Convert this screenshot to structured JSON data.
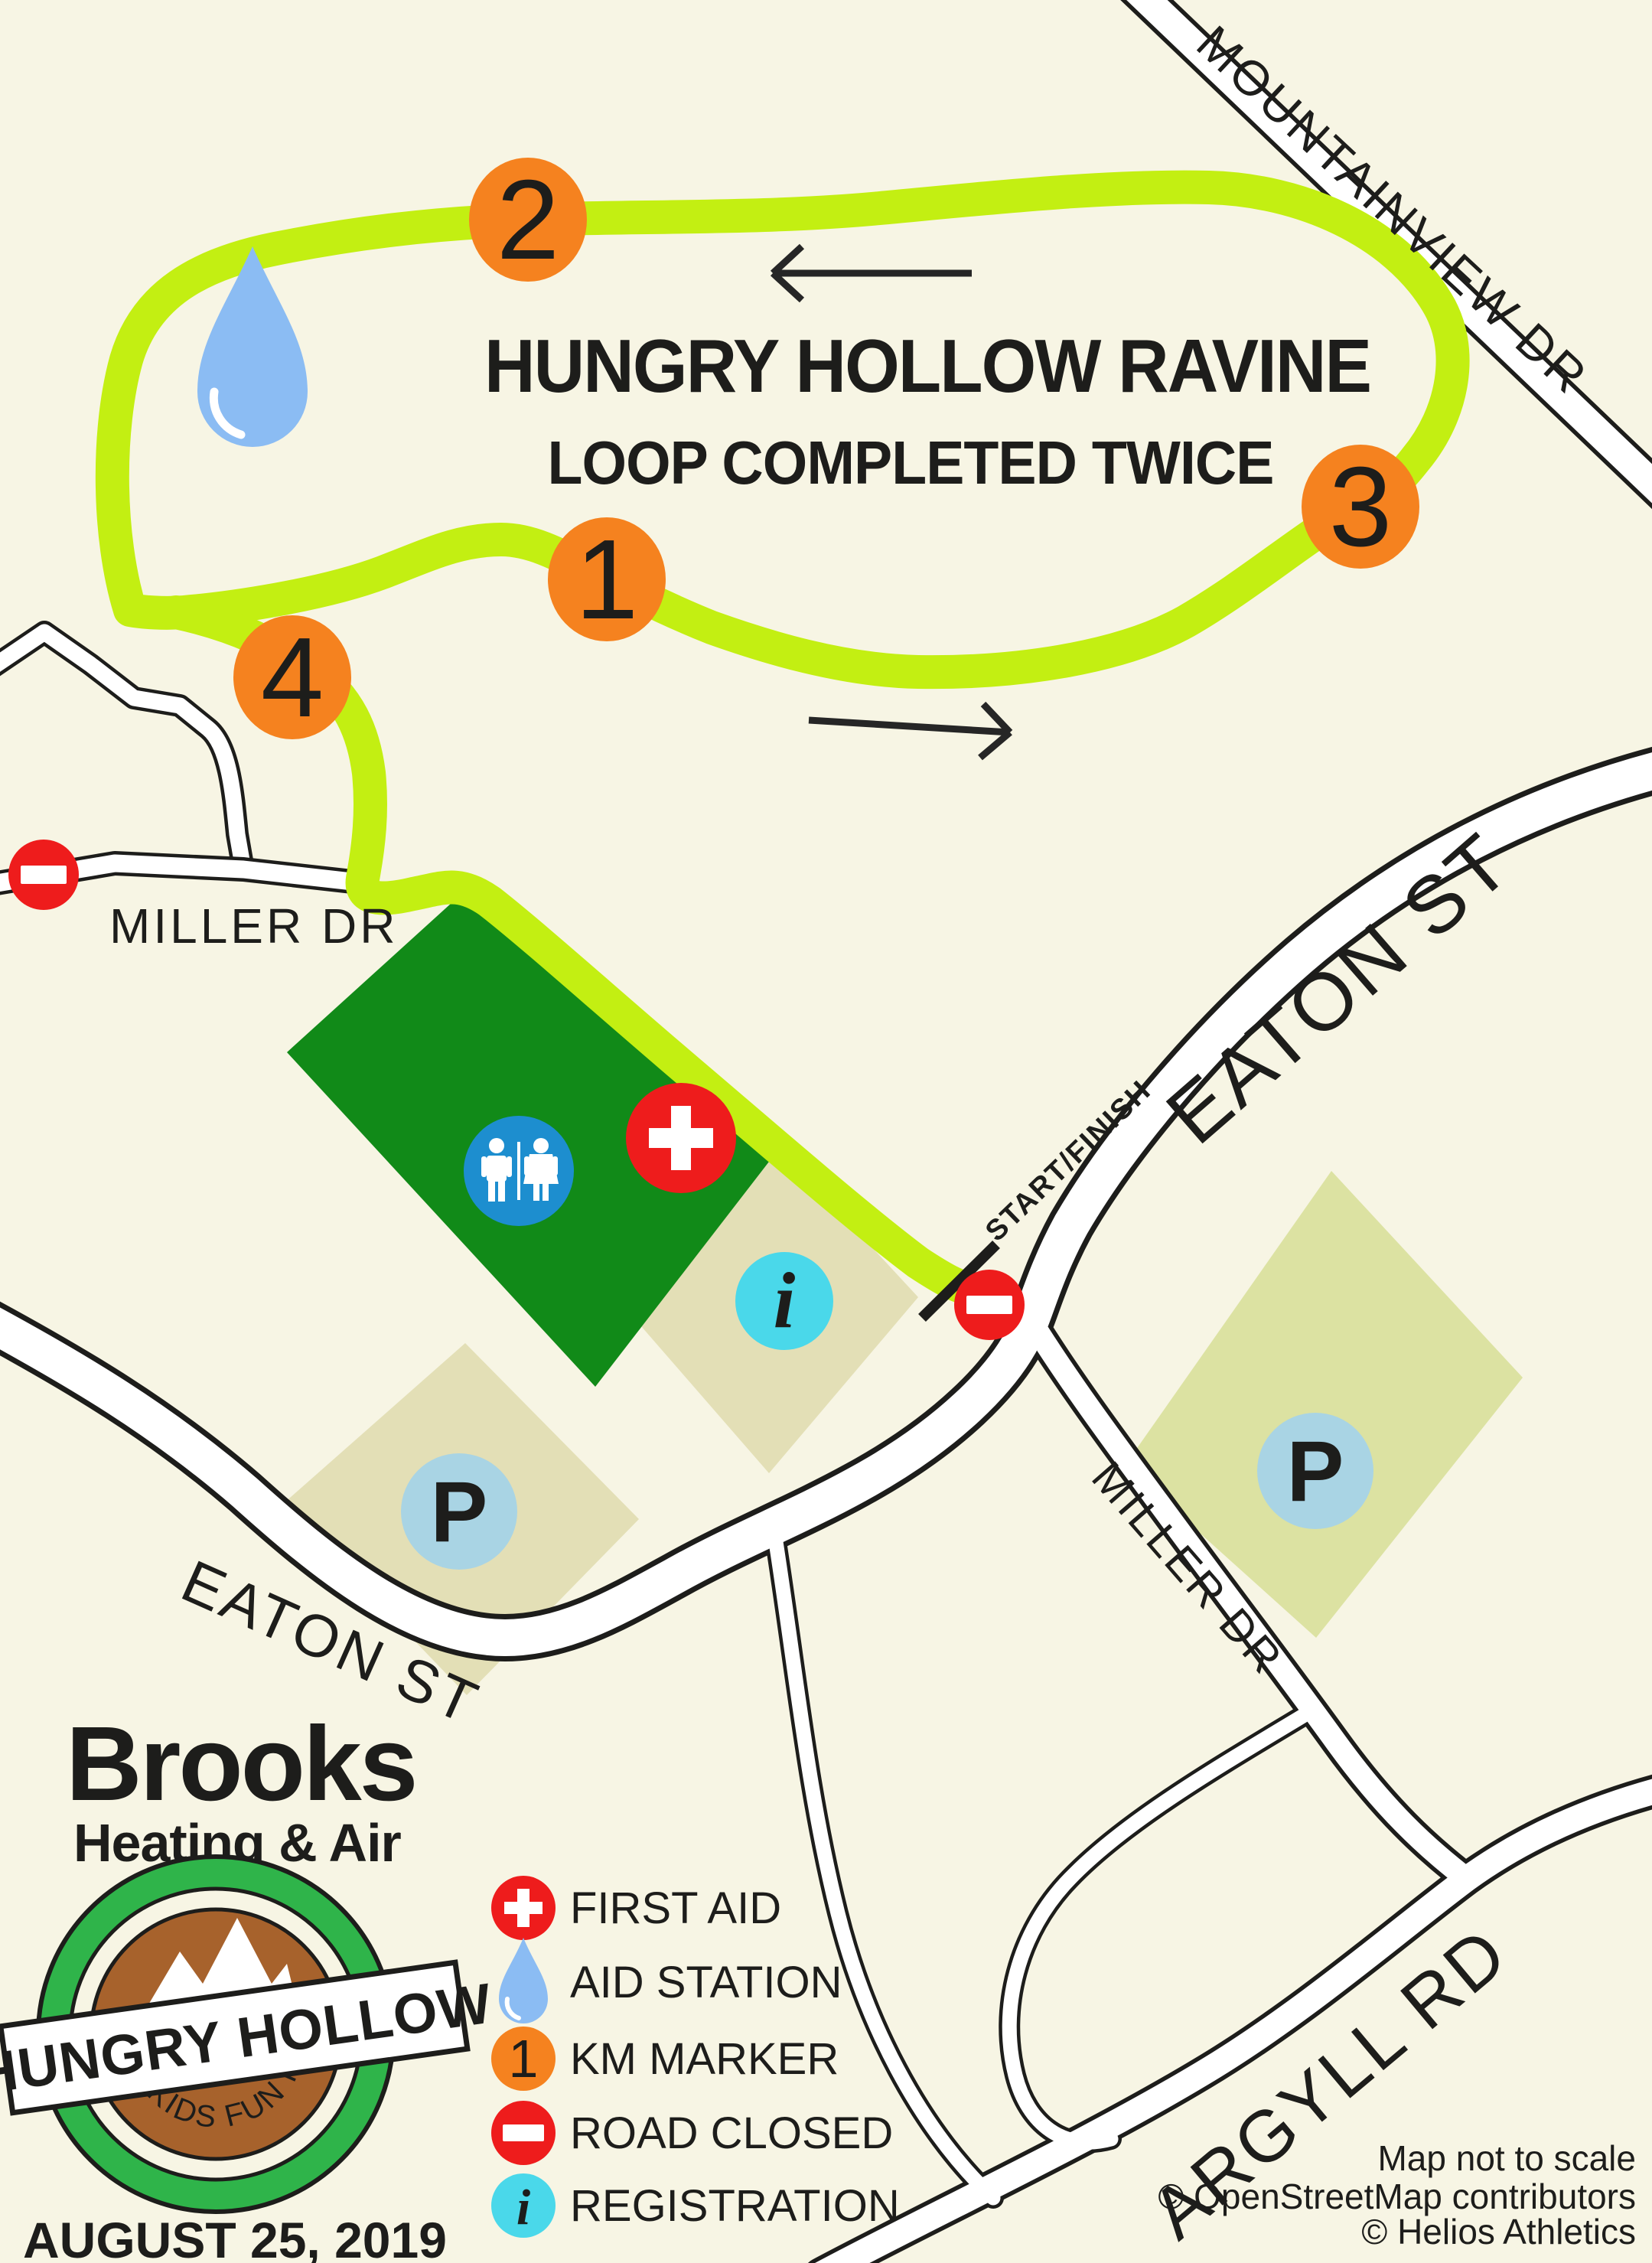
{
  "map": {
    "title": "HUNGRY HOLLOW RAVINE",
    "subtitle": "LOOP COMPLETED TWICE",
    "start_finish_label": "START/FINISH",
    "km_markers": [
      {
        "n": "1"
      },
      {
        "n": "2"
      },
      {
        "n": "3"
      },
      {
        "n": "4"
      }
    ],
    "road_labels": {
      "mountainview": "MOUNTAINVIEW DR",
      "miller_west": "MILLER DR",
      "miller_se": "MILLER DR",
      "eaton_upper": "EATON ST",
      "eaton_lower": "EATON ST",
      "argyll": "ARGYLL RD"
    },
    "parking_letter": "P",
    "info_letter": "i"
  },
  "legend": {
    "items": [
      {
        "icon": "first-aid-icon",
        "label": "FIRST AID"
      },
      {
        "icon": "aid-station-icon",
        "label": "AID STATION"
      },
      {
        "icon": "km-marker-icon",
        "label": "KM MARKER",
        "marker_number": "1"
      },
      {
        "icon": "road-closed-icon",
        "label": "ROAD CLOSED"
      },
      {
        "icon": "registration-icon",
        "label": "REGISTRATION"
      }
    ]
  },
  "sponsor": {
    "name": "Brooks",
    "tagline": "Heating & Air"
  },
  "badge": {
    "banner": "HUNGRY HOLLOW",
    "subtitle": "5K & KIDS FUN RUN"
  },
  "event_date": "AUGUST 25, 2019",
  "attribution": {
    "line1": "Map not to scale",
    "line2": "© OpenStreetMap contributors",
    "line3": "© Helios Athletics"
  },
  "colors": {
    "background": "#f7f5e4",
    "route_green": "#c3ef12",
    "marker_orange": "#f5821f",
    "park_green": "#118a18",
    "lot_tan": "#e3dfb6",
    "lot_khaki": "#dce2a2",
    "road_black": "#1d1d1b",
    "alert_red": "#ee1c1c",
    "restroom_blue": "#1d8ecf",
    "registration_cyan": "#4ad8ea",
    "parking_blue": "#a9d4e4",
    "drop_blue": "#8bbcf3",
    "brooks_olive": "#9fad62",
    "brooks_blue": "#1787c2",
    "badge_ring_green": "#2fb44a",
    "badge_brown": "#a7622c"
  }
}
